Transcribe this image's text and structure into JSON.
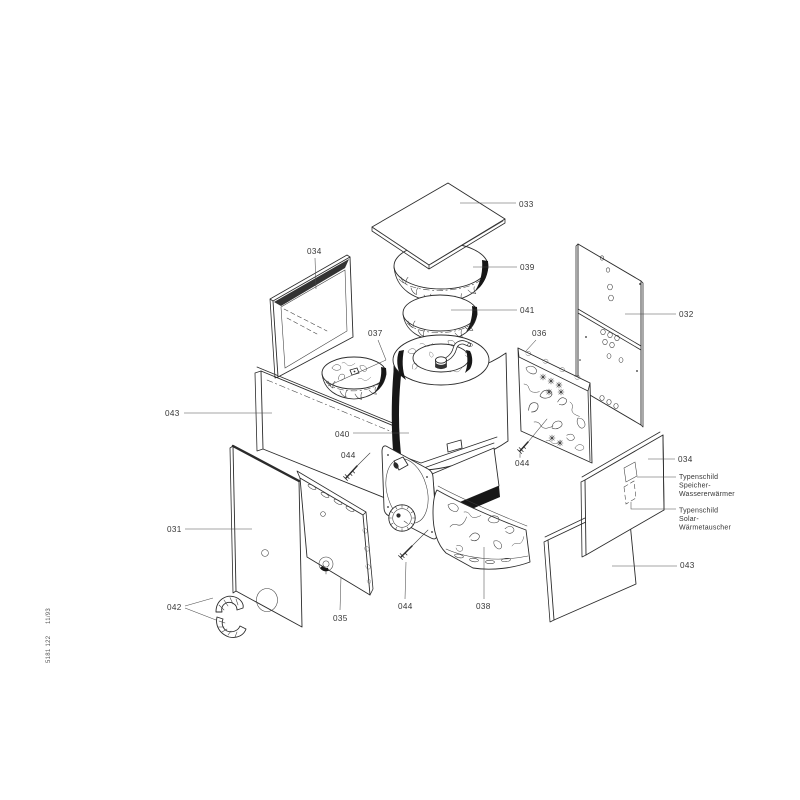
{
  "footer": {
    "doc_number": "5181 122",
    "date_code": "11/93"
  },
  "labels": [
    {
      "part": "033",
      "text": "033"
    },
    {
      "part": "034-front-panel",
      "text": "034"
    },
    {
      "part": "039",
      "text": "039"
    },
    {
      "part": "041",
      "text": "041"
    },
    {
      "part": "037",
      "text": "037"
    },
    {
      "part": "036",
      "text": "036"
    },
    {
      "part": "032",
      "text": "032"
    },
    {
      "part": "043-left",
      "text": "043"
    },
    {
      "part": "040",
      "text": "040"
    },
    {
      "part": "044-left",
      "text": "044"
    },
    {
      "part": "044-right",
      "text": "044"
    },
    {
      "part": "034-right",
      "text": "034"
    },
    {
      "part": "031",
      "text": "031"
    },
    {
      "part": "042",
      "text": "042"
    },
    {
      "part": "035",
      "text": "035"
    },
    {
      "part": "044-bottom",
      "text": "044"
    },
    {
      "part": "038",
      "text": "038"
    },
    {
      "part": "043-right",
      "text": "043"
    }
  ],
  "annotations": [
    {
      "lines": [
        "Typenschild",
        "Speicher-",
        "Wassererwärmer"
      ]
    },
    {
      "lines": [
        "Typenschild",
        "Solar-",
        "Wärmetauscher"
      ]
    }
  ],
  "colors": {
    "line": "#2b2b2b",
    "solid_black": "#171717",
    "paper": "#ffffff"
  }
}
